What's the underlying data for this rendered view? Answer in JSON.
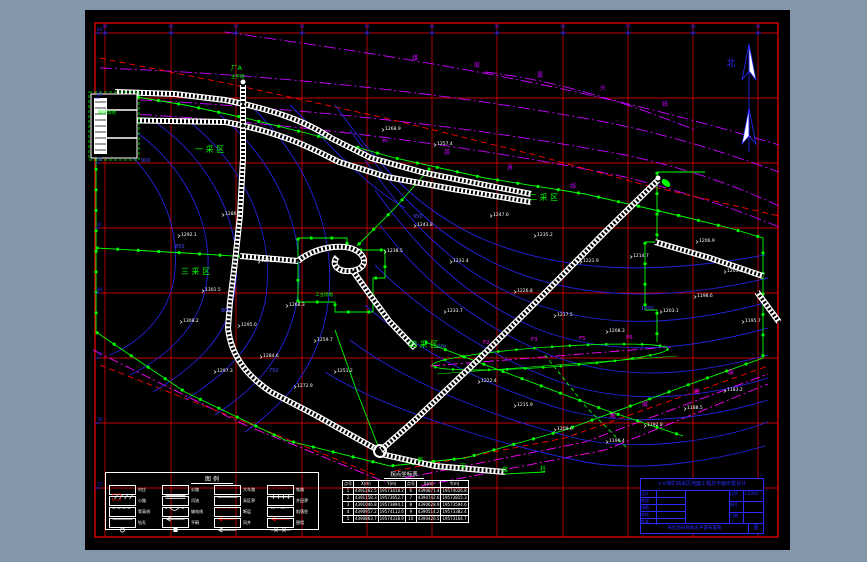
{
  "window": {
    "frame_bg": "#8496a9",
    "canvas_bg": "#000000"
  },
  "colors": {
    "grid": "#ff0000",
    "contour": "#2323dd",
    "boundary_green": "#00ff00",
    "strata_magenta": "#c800ff",
    "fault_magenta": "#ff00ff",
    "road_white": "#ffffff",
    "titleblock_blue": "#2a2aff"
  },
  "north": {
    "label": "北"
  },
  "grid": {
    "top_labels": [
      "89",
      "90",
      "91",
      "92",
      "93",
      "94",
      "95",
      "96",
      "97",
      "98",
      "99"
    ],
    "left_labels": [
      "84",
      "83",
      "82",
      "81",
      "80",
      "79",
      "78",
      "77"
    ]
  },
  "area_labels": [
    {
      "text": "一采区",
      "x": 110,
      "y": 142
    },
    {
      "text": "二采区",
      "x": 444,
      "y": 190
    },
    {
      "text": "三采区",
      "x": 96,
      "y": 264
    },
    {
      "text": "四采区",
      "x": 324,
      "y": 337
    }
  ],
  "poi_labels": [
    {
      "text": "厂A",
      "x": 146,
      "y": 60,
      "c": "#00ff00",
      "s": 6.5
    },
    {
      "text": "主平硐",
      "x": 146,
      "y": 68,
      "c": "#00ff00",
      "s": 4.5
    },
    {
      "text": "工业场地",
      "x": 230,
      "y": 286,
      "c": "#00ff00",
      "s": 4.5
    },
    {
      "text": "排矸场地",
      "x": 13,
      "y": 104,
      "c": "#00ff00",
      "s": 4.5
    }
  ],
  "contour_labels": [
    {
      "v": "900",
      "x": 56,
      "y": 152
    },
    {
      "v": "850",
      "x": 90,
      "y": 238
    },
    {
      "v": "800",
      "x": 136,
      "y": 302
    },
    {
      "v": "750",
      "x": 184,
      "y": 362
    },
    {
      "v": "950",
      "x": 328,
      "y": 208
    },
    {
      "v": "1000",
      "x": 556,
      "y": 300
    }
  ],
  "strata_labels": [
    {
      "chars": "煤层露头线",
      "c": "#c800ff",
      "pts": [
        [
          330,
          50
        ],
        [
          392,
          57
        ],
        [
          455,
          67
        ],
        [
          518,
          80
        ],
        [
          580,
          96
        ]
      ]
    },
    {
      "chars": "岩层界线",
      "c": "#c800ff",
      "pts": [
        [
          300,
          132
        ],
        [
          362,
          144
        ],
        [
          425,
          160
        ],
        [
          488,
          178
        ]
      ]
    },
    {
      "chars": "断层",
      "c": "#ff00ff",
      "pts": [
        [
          612,
          384
        ],
        [
          646,
          364
        ]
      ]
    },
    {
      "chars": "断层",
      "c": "#ff00ff",
      "pts": [
        [
          528,
          408
        ],
        [
          560,
          396
        ]
      ]
    },
    {
      "chars": "保安煤柱",
      "c": "#00ff00",
      "pts": [
        [
          335,
          452
        ],
        [
          378,
          458
        ],
        [
          420,
          462
        ],
        [
          458,
          461
        ]
      ]
    }
  ],
  "fault": {
    "labels": [
      {
        "t": "F2",
        "x": 398,
        "y": 334
      },
      {
        "t": "F3",
        "x": 446,
        "y": 331
      },
      {
        "t": "F5",
        "x": 494,
        "y": 330
      },
      {
        "t": "F6",
        "x": 541,
        "y": 329
      }
    ],
    "blue_label": {
      "t": "DF9",
      "x": 352,
      "y": 338
    }
  },
  "spot_elevations": [
    {
      "v": "1286.4",
      "x": 140,
      "y": 205
    },
    {
      "v": "1292.1",
      "x": 96,
      "y": 226
    },
    {
      "v": "1275.8",
      "x": 176,
      "y": 252
    },
    {
      "v": "1301.5",
      "x": 120,
      "y": 281
    },
    {
      "v": "1268.3",
      "x": 204,
      "y": 296
    },
    {
      "v": "1295.0",
      "x": 156,
      "y": 316
    },
    {
      "v": "1308.2",
      "x": 98,
      "y": 312
    },
    {
      "v": "1259.7",
      "x": 232,
      "y": 331
    },
    {
      "v": "1284.6",
      "x": 178,
      "y": 347
    },
    {
      "v": "1297.3",
      "x": 132,
      "y": 362
    },
    {
      "v": "1251.2",
      "x": 252,
      "y": 362
    },
    {
      "v": "1272.9",
      "x": 212,
      "y": 377
    },
    {
      "v": "1243.8",
      "x": 332,
      "y": 216
    },
    {
      "v": "1238.5",
      "x": 302,
      "y": 242
    },
    {
      "v": "1231.4",
      "x": 368,
      "y": 252
    },
    {
      "v": "1247.6",
      "x": 408,
      "y": 206
    },
    {
      "v": "1235.2",
      "x": 452,
      "y": 226
    },
    {
      "v": "1221.9",
      "x": 498,
      "y": 252
    },
    {
      "v": "1214.7",
      "x": 548,
      "y": 247
    },
    {
      "v": "1226.8",
      "x": 432,
      "y": 282
    },
    {
      "v": "1217.5",
      "x": 472,
      "y": 306
    },
    {
      "v": "1208.3",
      "x": 524,
      "y": 322
    },
    {
      "v": "1203.1",
      "x": 578,
      "y": 302
    },
    {
      "v": "1198.6",
      "x": 612,
      "y": 287
    },
    {
      "v": "1233.7",
      "x": 362,
      "y": 302
    },
    {
      "v": "1222.4",
      "x": 396,
      "y": 372
    },
    {
      "v": "1215.9",
      "x": 432,
      "y": 396
    },
    {
      "v": "1209.6",
      "x": 472,
      "y": 420
    },
    {
      "v": "1196.4",
      "x": 524,
      "y": 432
    },
    {
      "v": "1192.8",
      "x": 562,
      "y": 416
    },
    {
      "v": "1188.5",
      "x": 602,
      "y": 399
    },
    {
      "v": "1183.2",
      "x": 642,
      "y": 381
    },
    {
      "v": "1195.7",
      "x": 660,
      "y": 312
    },
    {
      "v": "1201.3",
      "x": 642,
      "y": 262
    },
    {
      "v": "1206.9",
      "x": 614,
      "y": 232
    },
    {
      "v": "1268.9",
      "x": 300,
      "y": 120
    },
    {
      "v": "1257.4",
      "x": 352,
      "y": 135
    }
  ],
  "legend": {
    "title": "图 例",
    "items": [
      {
        "label": "村庄",
        "sym": "hatch"
      },
      {
        "label": "公路",
        "sym": "dline"
      },
      {
        "label": "大车路",
        "sym": "line"
      },
      {
        "label": "铁路",
        "sym": "ticks"
      },
      {
        "label": "小路",
        "sym": "dash"
      },
      {
        "label": "河流",
        "sym": "wavy"
      },
      {
        "label": "采区界",
        "sym": "reddash"
      },
      {
        "label": "井田界",
        "sym": "dashdot"
      },
      {
        "label": "等高线",
        "sym": "line"
      },
      {
        "label": "输电线",
        "sym": "warrow"
      },
      {
        "label": "断层",
        "sym": "redarrow"
      },
      {
        "label": "陷落柱",
        "sym": "redarrow"
      },
      {
        "label": "钻孔",
        "sym": "circle"
      },
      {
        "label": "平硐",
        "sym": "sq"
      },
      {
        "label": "风井",
        "sym": "warrow"
      },
      {
        "label": "围墙",
        "sym": "xline"
      }
    ]
  },
  "table": {
    "title": "拐点坐标表",
    "headers": [
      "点号",
      "X(m)",
      "Y(m)",
      "点号",
      "X(m)",
      "Y(m)"
    ],
    "rows": [
      [
        "1",
        "4391262.5",
        "19573418.2",
        "6",
        "4390871.4",
        "19574026.8"
      ],
      [
        "2",
        "4391158.3",
        "19573652.7",
        "7",
        "4390742.6",
        "19573815.3"
      ],
      [
        "3",
        "4391046.8",
        "19573894.1",
        "8",
        "4390628.9",
        "19573594.6"
      ],
      [
        "4",
        "4390957.2",
        "19574112.6",
        "9",
        "4390514.2",
        "19573382.4"
      ],
      [
        "5",
        "4390863.7",
        "19574318.9",
        "10",
        "4390426.5",
        "19573164.7"
      ]
    ]
  },
  "titleblock": {
    "header": "××煤矿四采区地面工程总平面布置设计",
    "rows_left": [
      {
        "label": "设计",
        "value": ""
      },
      {
        "label": "制图",
        "value": ""
      },
      {
        "label": "描图",
        "value": ""
      },
      {
        "label": "审核",
        "value": ""
      },
      {
        "label": "批准",
        "value": ""
      }
    ],
    "rows_right": [
      {
        "label": "比例",
        "value": "1:2000"
      },
      {
        "label": "图号",
        "value": ""
      },
      {
        "label": "日期",
        "value": ""
      }
    ],
    "drawing_name": "采区地形地质总平面布置图",
    "sheet": "图"
  }
}
